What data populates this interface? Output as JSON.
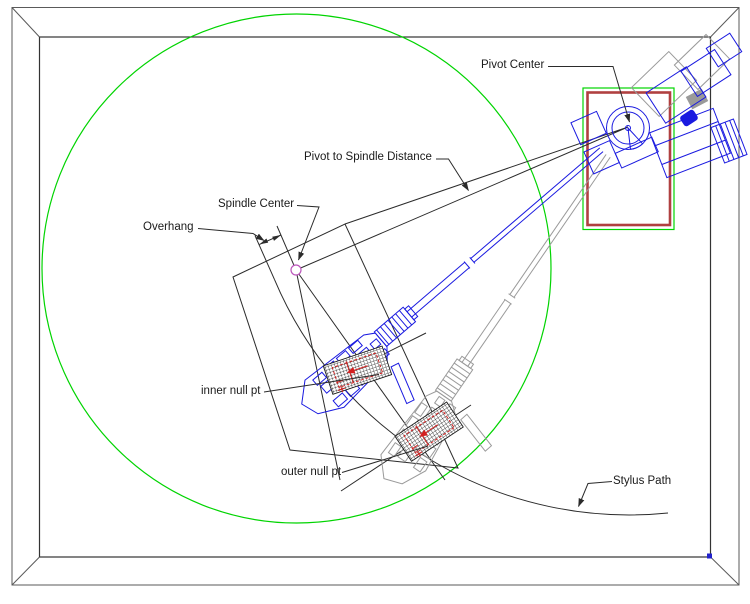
{
  "labels": {
    "pivot_center": "Pivot Center",
    "pivot_to_spindle": "Pivot to Spindle Distance",
    "spindle_center": "Spindle Center",
    "overhang": "Overhang",
    "inner_null": "inner null pt",
    "outer_null": "outer null pt",
    "stylus_path": "Stylus Path"
  },
  "colors": {
    "green": "#00d400",
    "blue": "#1a1ae0",
    "ghost": "#9a9a9a",
    "red_board": "#b04040",
    "red_detail": "#d42020",
    "spindle": "#bb55bb",
    "ink": "#2b2b2b"
  }
}
